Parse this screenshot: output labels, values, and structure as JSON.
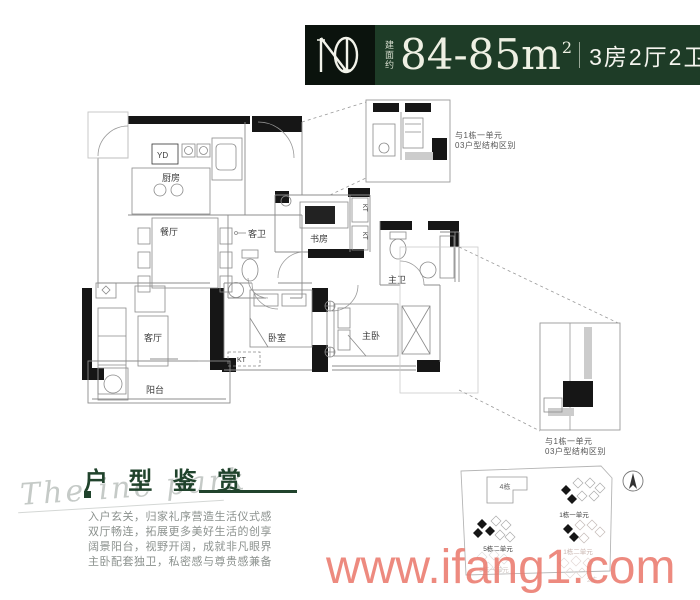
{
  "header": {
    "area_prefix": "建面约",
    "area_value": "84-85m",
    "area_sup": "2",
    "spec": "3房2厅2卫"
  },
  "plan": {
    "rooms": {
      "kitchen": "厨房",
      "dining": "餐厅",
      "living": "客厅",
      "balcony": "阳台",
      "guest_bath": "客卫",
      "study": "书房",
      "bedroom": "卧室",
      "master_bedroom": "主卧",
      "master_bath": "主卫"
    },
    "tags": {
      "yd": "YD",
      "kt": "KT"
    }
  },
  "callouts": {
    "top": {
      "line1": "与1栋一单元",
      "line2": "03户型结构区别"
    },
    "bottom": {
      "line1": "与1栋一单元",
      "line2": "03户型结构区别"
    }
  },
  "editorial": {
    "script": "The inc park",
    "title": "户 型 鉴 赏",
    "paragraph": [
      "入户玄关，归家礼序营造生活仪式感",
      "双厅畅连，拓展更多美好生活的创享",
      "阔景阳台，视野开阔，成就非凡眼界",
      "主卧配套独卫，私密感与尊贵感兼备"
    ]
  },
  "site_plan": {
    "labels": {
      "b4": "4栋",
      "u1a": "1栋一单元",
      "u5b": "5栋二单元",
      "u1b": "1栋二单元",
      "u5a": "5栋一单元",
      "b2": "2栋"
    }
  },
  "watermark": {
    "text": "www.ifang1.com",
    "color": "#eb7a6e"
  },
  "colors": {
    "header_green": "#1e3c27",
    "logo_bg": "#0b130d",
    "title_green": "#20432c"
  }
}
